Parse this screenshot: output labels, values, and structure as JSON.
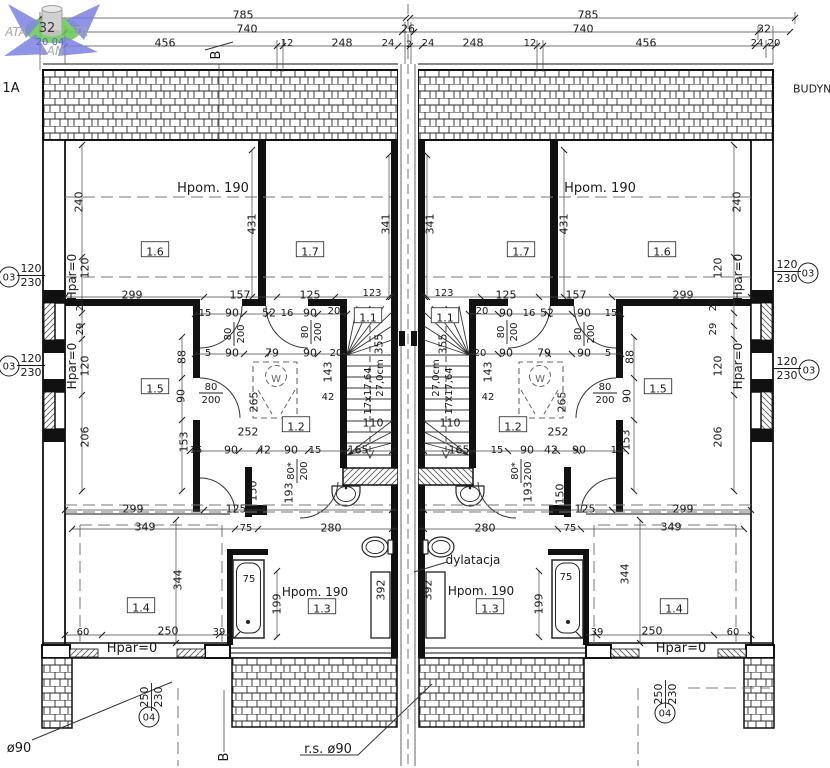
{
  "drawing_type": "architectural-floor-plan",
  "building_labels": {
    "left": "1A",
    "right": "BUDYNE"
  },
  "watermark": {
    "arrow_color": "#7a7fe3",
    "ellipse_color": "#66c94c",
    "texts": [
      {
        "t": "ATA",
        "x": 16,
        "y": 32,
        "s": 12,
        "i": 1,
        "f": 1,
        "c": "#a8a8a8",
        "n": "watermark-text"
      },
      {
        "t": "TA",
        "x": 81,
        "y": 32,
        "s": 12,
        "i": 1,
        "f": 1,
        "c": "#a8a8a8",
        "n": "watermark-text"
      },
      {
        "t": "LAN",
        "x": 52,
        "y": 51,
        "s": 12,
        "i": 1,
        "f": 1,
        "c": "#a8a8a8",
        "n": "watermark-text"
      },
      {
        "t": "32",
        "x": 47,
        "y": 28,
        "s": 13,
        "c": "#3a3a3a",
        "n": "watermark-text"
      },
      {
        "t": "20 04",
        "x": 50,
        "y": 42,
        "s": 10,
        "c": "#5c5ce0",
        "n": "watermark-text"
      }
    ]
  },
  "labels": [
    {
      "t": "785",
      "x": 243,
      "y": 15
    },
    {
      "t": "785",
      "x": 588,
      "y": 15
    },
    {
      "t": "740",
      "x": 247,
      "y": 29
    },
    {
      "t": "26",
      "x": 408,
      "y": 29
    },
    {
      "t": "740",
      "x": 583,
      "y": 29
    },
    {
      "t": "32",
      "x": 764,
      "y": 29
    },
    {
      "t": "456",
      "x": 165,
      "y": 43
    },
    {
      "t": "12",
      "x": 287,
      "y": 43,
      "s": 10
    },
    {
      "t": "248",
      "x": 342,
      "y": 43
    },
    {
      "t": "24",
      "x": 388,
      "y": 43,
      "s": 10
    },
    {
      "t": "2",
      "x": 409,
      "y": 44,
      "s": 9
    },
    {
      "t": "24",
      "x": 428,
      "y": 43,
      "s": 10
    },
    {
      "t": "248",
      "x": 473,
      "y": 43
    },
    {
      "t": "12",
      "x": 530,
      "y": 43,
      "s": 10
    },
    {
      "t": "456",
      "x": 646,
      "y": 43
    },
    {
      "t": "24",
      "x": 757,
      "y": 43,
      "s": 10
    },
    {
      "t": "20",
      "x": 774,
      "y": 43,
      "s": 10
    },
    {
      "t": "B",
      "x": 216,
      "y": 55,
      "r": -90,
      "s": 13,
      "n": "section-marker-b-top"
    },
    {
      "t": "B",
      "x": 224,
      "y": 757,
      "r": -90,
      "s": 13,
      "n": "section-marker-b-bottom"
    },
    {
      "t": "1A",
      "x": 11,
      "y": 88,
      "s": 13,
      "n": "building-label-left"
    },
    {
      "t": "BUDYNE",
      "x": 793,
      "y": 89,
      "s": 11,
      "a": "start",
      "n": "building-label-right"
    },
    {
      "t": "Hpom. 190",
      "x": 213,
      "y": 188,
      "s": 13,
      "n": "room-height-label"
    },
    {
      "t": "Hpom. 190",
      "x": 600,
      "y": 188,
      "s": 13,
      "n": "room-height-label"
    },
    {
      "t": "240",
      "x": 79,
      "y": 202,
      "r": -90
    },
    {
      "t": "240",
      "x": 737,
      "y": 202,
      "r": -90
    },
    {
      "t": "431",
      "x": 252,
      "y": 224,
      "r": -90
    },
    {
      "t": "431",
      "x": 564,
      "y": 224,
      "r": -90
    },
    {
      "t": "341",
      "x": 386,
      "y": 224,
      "r": -90
    },
    {
      "t": "341",
      "x": 430,
      "y": 224,
      "r": -90
    },
    {
      "t": "1.6",
      "x": 155,
      "y": 252,
      "b": 1,
      "n": "room-number"
    },
    {
      "t": "1.7",
      "x": 310,
      "y": 252,
      "b": 1,
      "n": "room-number"
    },
    {
      "t": "1.7",
      "x": 521,
      "y": 252,
      "b": 1,
      "n": "room-number"
    },
    {
      "t": "1.6",
      "x": 662,
      "y": 252,
      "b": 1,
      "n": "room-number"
    },
    {
      "t": "120",
      "x": 85,
      "y": 268,
      "r": -90
    },
    {
      "t": "120",
      "x": 718,
      "y": 268,
      "r": -90
    },
    {
      "t": "Hpar=0",
      "x": 72,
      "y": 277,
      "r": -90,
      "s": 12,
      "n": "wall-height-label"
    },
    {
      "t": "Hpar=0",
      "x": 738,
      "y": 277,
      "r": -90,
      "s": 12,
      "n": "wall-height-label"
    },
    {
      "t": "29",
      "x": 80,
      "y": 305,
      "r": -90,
      "s": 10
    },
    {
      "t": "29",
      "x": 80,
      "y": 329,
      "r": -90,
      "s": 10
    },
    {
      "t": "29",
      "x": 713,
      "y": 305,
      "r": -90,
      "s": 10
    },
    {
      "t": "29",
      "x": 713,
      "y": 329,
      "r": -90,
      "s": 10
    },
    {
      "t": "120",
      "x": 85,
      "y": 366,
      "r": -90
    },
    {
      "t": "120",
      "x": 718,
      "y": 366,
      "r": -90
    },
    {
      "t": "Hpar=0",
      "x": 72,
      "y": 366,
      "r": -90,
      "s": 12,
      "n": "wall-height-label"
    },
    {
      "t": "Hpar=0",
      "x": 738,
      "y": 366,
      "r": -90,
      "s": 12,
      "n": "wall-height-label"
    },
    {
      "t": "206",
      "x": 85,
      "y": 437,
      "r": -90
    },
    {
      "t": "206",
      "x": 718,
      "y": 437,
      "r": -90
    },
    {
      "t": "299",
      "x": 132,
      "y": 295
    },
    {
      "t": "157",
      "x": 240,
      "y": 295
    },
    {
      "t": "125",
      "x": 310,
      "y": 295
    },
    {
      "t": "123",
      "x": 372,
      "y": 293,
      "s": 10
    },
    {
      "t": "123",
      "x": 444,
      "y": 293,
      "s": 10
    },
    {
      "t": "125",
      "x": 506,
      "y": 295
    },
    {
      "t": "157",
      "x": 576,
      "y": 295
    },
    {
      "t": "299",
      "x": 683,
      "y": 295
    },
    {
      "t": "15",
      "x": 205,
      "y": 313,
      "s": 10
    },
    {
      "t": "90",
      "x": 232,
      "y": 313
    },
    {
      "t": "52",
      "x": 269,
      "y": 313
    },
    {
      "t": "16",
      "x": 287,
      "y": 313,
      "s": 10
    },
    {
      "t": "90",
      "x": 310,
      "y": 313
    },
    {
      "t": "20",
      "x": 334,
      "y": 311,
      "s": 10
    },
    {
      "t": "20",
      "x": 482,
      "y": 311,
      "s": 10
    },
    {
      "t": "90",
      "x": 506,
      "y": 313
    },
    {
      "t": "16",
      "x": 529,
      "y": 313,
      "s": 10
    },
    {
      "t": "52",
      "x": 547,
      "y": 313
    },
    {
      "t": "90",
      "x": 584,
      "y": 313
    },
    {
      "t": "15",
      "x": 611,
      "y": 313,
      "s": 10
    },
    {
      "t": "5",
      "x": 208,
      "y": 353,
      "s": 10
    },
    {
      "t": "90",
      "x": 232,
      "y": 353
    },
    {
      "t": "79",
      "x": 272,
      "y": 353
    },
    {
      "t": "90",
      "x": 310,
      "y": 353
    },
    {
      "t": "20",
      "x": 336,
      "y": 353,
      "s": 10
    },
    {
      "t": "20",
      "x": 480,
      "y": 353,
      "s": 10
    },
    {
      "t": "90",
      "x": 506,
      "y": 353
    },
    {
      "t": "79",
      "x": 544,
      "y": 353
    },
    {
      "t": "90",
      "x": 584,
      "y": 353
    },
    {
      "t": "5",
      "x": 608,
      "y": 353,
      "s": 10
    },
    {
      "t": "88",
      "x": 182,
      "y": 357,
      "r": -90
    },
    {
      "t": "88",
      "x": 630,
      "y": 357,
      "r": -90
    },
    {
      "t": "90",
      "x": 181,
      "y": 396,
      "r": -90
    },
    {
      "t": "90",
      "x": 627,
      "y": 396,
      "r": -90
    },
    {
      "t": "153",
      "x": 184,
      "y": 442,
      "r": -90
    },
    {
      "t": "153",
      "x": 626,
      "y": 440,
      "r": -90
    },
    {
      "t": "1.5",
      "x": 155,
      "y": 389,
      "b": 1,
      "n": "room-number"
    },
    {
      "t": "1.5",
      "x": 658,
      "y": 389,
      "b": 1,
      "n": "room-number"
    },
    {
      "t": "265",
      "x": 254,
      "y": 402,
      "r": -90
    },
    {
      "t": "265",
      "x": 562,
      "y": 402,
      "r": -90
    },
    {
      "t": "143",
      "x": 328,
      "y": 372,
      "r": -90
    },
    {
      "t": "143",
      "x": 488,
      "y": 372,
      "r": -90
    },
    {
      "t": "42",
      "x": 328,
      "y": 397,
      "s": 10
    },
    {
      "t": "42",
      "x": 488,
      "y": 397,
      "s": 10
    },
    {
      "t": "W",
      "x": 276,
      "y": 379,
      "s": 10,
      "c": "#666",
      "n": "washer-symbol"
    },
    {
      "t": "W",
      "x": 540,
      "y": 379,
      "s": 10,
      "c": "#666",
      "n": "washer-symbol"
    },
    {
      "t": "1.1",
      "x": 368,
      "y": 318,
      "b": 1,
      "n": "room-number"
    },
    {
      "t": "1.1",
      "x": 445,
      "y": 318,
      "b": 1,
      "n": "room-number"
    },
    {
      "t": "355",
      "x": 379,
      "y": 344,
      "r": -90
    },
    {
      "t": "355",
      "x": 443,
      "y": 344,
      "r": -90
    },
    {
      "t": "17x17,64",
      "x": 368,
      "y": 391,
      "r": -90,
      "s": 10,
      "n": "stair-riser-label"
    },
    {
      "t": "17x17,64",
      "x": 449,
      "y": 391,
      "r": -90,
      "s": 10,
      "n": "stair-riser-label"
    },
    {
      "t": "27,0cm",
      "x": 380,
      "y": 378,
      "r": -90,
      "s": 10,
      "n": "stair-tread-label"
    },
    {
      "t": "27,0cm",
      "x": 436,
      "y": 378,
      "r": -90,
      "s": 10,
      "n": "stair-tread-label"
    },
    {
      "t": "110",
      "x": 373,
      "y": 423
    },
    {
      "t": "110",
      "x": 450,
      "y": 423
    },
    {
      "t": "165",
      "x": 358,
      "y": 450
    },
    {
      "t": "165",
      "x": 459,
      "y": 450
    },
    {
      "t": "15",
      "x": 497,
      "y": 450,
      "s": 10
    },
    {
      "t": "1.2",
      "x": 296,
      "y": 427,
      "b": 1,
      "n": "room-number"
    },
    {
      "t": "1.2",
      "x": 513,
      "y": 427,
      "b": 1,
      "n": "room-number"
    },
    {
      "t": "252",
      "x": 248,
      "y": 432
    },
    {
      "t": "252",
      "x": 558,
      "y": 432
    },
    {
      "t": "15",
      "x": 196,
      "y": 450,
      "s": 10
    },
    {
      "t": "90",
      "x": 231,
      "y": 450
    },
    {
      "t": "42",
      "x": 264,
      "y": 450
    },
    {
      "t": "90",
      "x": 291,
      "y": 450
    },
    {
      "t": "15",
      "x": 315,
      "y": 450,
      "s": 10
    },
    {
      "t": "90",
      "x": 527,
      "y": 450
    },
    {
      "t": "42",
      "x": 551,
      "y": 450
    },
    {
      "t": "90",
      "x": 579,
      "y": 450
    },
    {
      "t": "15",
      "x": 617,
      "y": 450,
      "s": 10
    },
    {
      "t": "150",
      "x": 253,
      "y": 491,
      "r": -90
    },
    {
      "t": "150",
      "x": 560,
      "y": 494,
      "r": -90
    },
    {
      "t": "193",
      "x": 289,
      "y": 493,
      "r": -90
    },
    {
      "t": "193",
      "x": 528,
      "y": 492,
      "r": -90
    },
    {
      "t": "125",
      "x": 236,
      "y": 509
    },
    {
      "t": "125",
      "x": 585,
      "y": 509
    },
    {
      "t": "299",
      "x": 133,
      "y": 509
    },
    {
      "t": "299",
      "x": 683,
      "y": 509
    },
    {
      "t": "349",
      "x": 145,
      "y": 527
    },
    {
      "t": "349",
      "x": 671,
      "y": 527
    },
    {
      "t": "75",
      "x": 246,
      "y": 528,
      "s": 10
    },
    {
      "t": "75",
      "x": 570,
      "y": 528,
      "s": 10
    },
    {
      "t": "280",
      "x": 331,
      "y": 528
    },
    {
      "t": "280",
      "x": 485,
      "y": 528
    },
    {
      "t": "75",
      "x": 249,
      "y": 579,
      "s": 10
    },
    {
      "t": "75",
      "x": 566,
      "y": 577,
      "s": 10
    },
    {
      "t": "344",
      "x": 178,
      "y": 580,
      "r": -90
    },
    {
      "t": "344",
      "x": 625,
      "y": 574,
      "r": -90
    },
    {
      "t": "199",
      "x": 277,
      "y": 604,
      "r": -90
    },
    {
      "t": "199",
      "x": 539,
      "y": 604,
      "r": -90
    },
    {
      "t": "1.4",
      "x": 141,
      "y": 608,
      "b": 1,
      "n": "room-number"
    },
    {
      "t": "1.4",
      "x": 674,
      "y": 609,
      "b": 1,
      "n": "room-number"
    },
    {
      "t": "Hpom. 190",
      "x": 315,
      "y": 592,
      "s": 12,
      "n": "room-height-label"
    },
    {
      "t": "Hpom. 190",
      "x": 481,
      "y": 591,
      "s": 12,
      "n": "room-height-label"
    },
    {
      "t": "1.3",
      "x": 322,
      "y": 609,
      "b": 1,
      "n": "room-number"
    },
    {
      "t": "1.3",
      "x": 490,
      "y": 609,
      "b": 1,
      "n": "room-number"
    },
    {
      "t": "392",
      "x": 381,
      "y": 590,
      "r": -90
    },
    {
      "t": "392",
      "x": 428,
      "y": 590,
      "r": -90
    },
    {
      "t": "dylatacja",
      "x": 473,
      "y": 560,
      "s": 12,
      "n": "dilatation-label"
    },
    {
      "t": "39",
      "x": 219,
      "y": 632,
      "s": 10
    },
    {
      "t": "39",
      "x": 597,
      "y": 632,
      "s": 10
    },
    {
      "t": "250",
      "x": 168,
      "y": 631
    },
    {
      "t": "250",
      "x": 652,
      "y": 631
    },
    {
      "t": "60",
      "x": 83,
      "y": 632,
      "s": 10
    },
    {
      "t": "60",
      "x": 733,
      "y": 632,
      "s": 10
    },
    {
      "t": "Hpar=0",
      "x": 132,
      "y": 648,
      "s": 13,
      "n": "wall-height-label"
    },
    {
      "t": "Hpar=0",
      "x": 681,
      "y": 648,
      "s": 13,
      "n": "wall-height-label"
    },
    {
      "t": "r.s. ø90",
      "x": 328,
      "y": 749,
      "s": 13,
      "n": "rainwater-pipe-label"
    },
    {
      "t": "ø90",
      "x": 19,
      "y": 748,
      "s": 13,
      "n": "rainwater-pipe-label"
    }
  ],
  "fractions": [
    {
      "num": "80",
      "den": "200",
      "x": 233,
      "y": 334,
      "r": -90
    },
    {
      "num": "80",
      "den": "200",
      "x": 310,
      "y": 332,
      "r": -90
    },
    {
      "num": "80",
      "den": "200",
      "x": 211,
      "y": 392,
      "r": 0
    },
    {
      "num": "80",
      "den": "200",
      "x": 583,
      "y": 334,
      "r": -90
    },
    {
      "num": "80",
      "den": "200",
      "x": 506,
      "y": 332,
      "r": -90
    },
    {
      "num": "80",
      "den": "200",
      "x": 605,
      "y": 392,
      "r": 0
    },
    {
      "num": "80*",
      "den": "200",
      "x": 296,
      "y": 471,
      "r": -90
    },
    {
      "num": "80*",
      "den": "200",
      "x": 520,
      "y": 471,
      "r": -90
    }
  ],
  "markers": [
    {
      "sym": "03",
      "cx": 9,
      "cy": 277,
      "num": "120",
      "den": "230",
      "tx": 31,
      "ty": 274,
      "rot": 0
    },
    {
      "sym": "03",
      "cx": 9,
      "cy": 366,
      "num": "120",
      "den": "230",
      "tx": 31,
      "ty": 364,
      "rot": 0
    },
    {
      "sym": "03",
      "cx": 808,
      "cy": 273,
      "num": "120",
      "den": "230",
      "tx": 787,
      "ty": 270,
      "rot": 0
    },
    {
      "sym": "03",
      "cx": 809,
      "cy": 370,
      "num": "120",
      "den": "230",
      "tx": 787,
      "ty": 367,
      "rot": 0
    },
    {
      "sym": "04",
      "cx": 149,
      "cy": 717,
      "num": "250",
      "den": "230",
      "tx": 150,
      "ty": 697,
      "rot": -90
    },
    {
      "sym": "04",
      "cx": 665,
      "cy": 713,
      "num": "250",
      "den": "230",
      "tx": 664,
      "ty": 694,
      "rot": -90
    }
  ]
}
